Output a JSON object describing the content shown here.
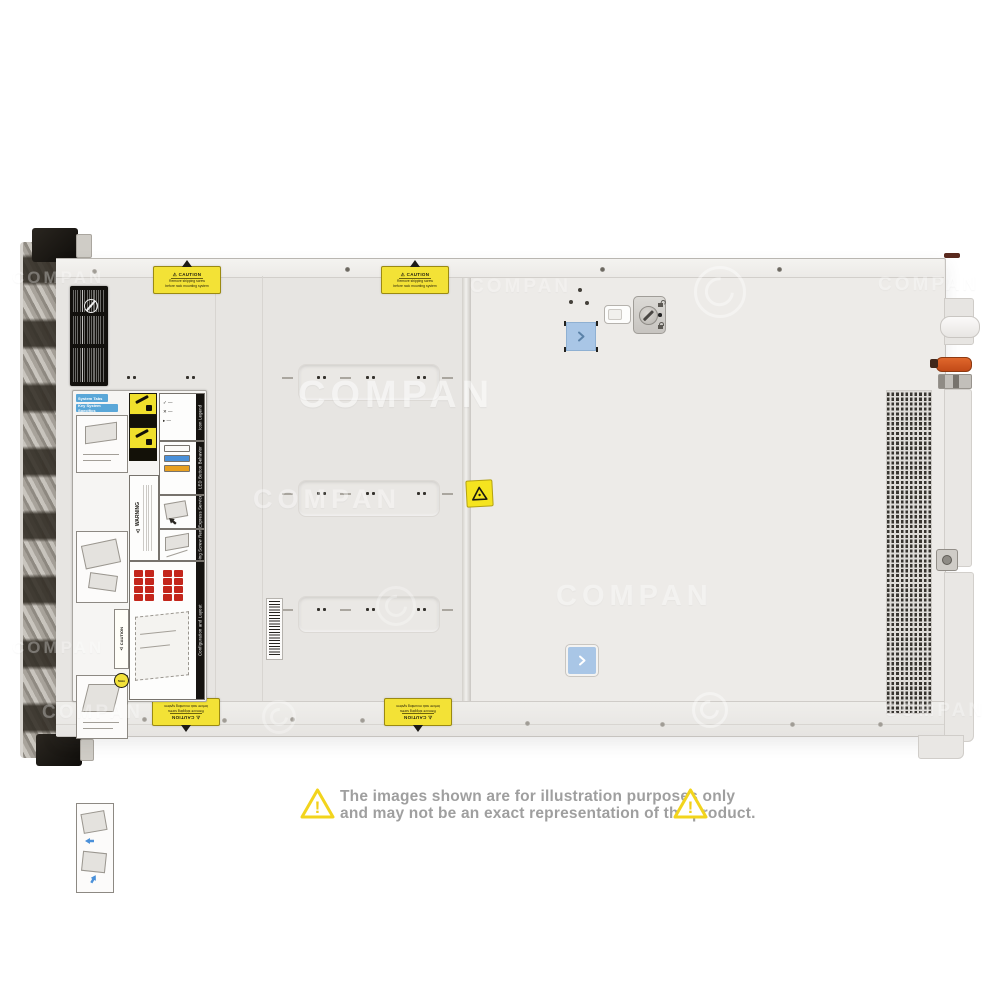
{
  "page": {
    "background": "#ffffff"
  },
  "watermark": {
    "text": "COMPAN"
  },
  "icons": {
    "warning": "⚠"
  },
  "disclaimer": {
    "line1": "The images shown are for illustration purposes only",
    "line2": "and may not be an exact representation of the product."
  },
  "server": {
    "caution_sticker": {
      "title": "CAUTION",
      "line1": "Remove shipping screw",
      "line2": "before rack mounting system"
    },
    "service_label": {
      "tab1": "System Tabs",
      "tab2": "Key System Specifics",
      "warning_heading": "WARNING",
      "caution_heading": "CAUTION",
      "timer": "5min",
      "sections": [
        {
          "title": "Icon Legend"
        },
        {
          "title": "LED Button Behavior"
        },
        {
          "title": "Rear Express Service Tag"
        },
        {
          "title": "Shipping Screw Removal"
        },
        {
          "title": "Configuration and Layout"
        }
      ]
    },
    "colors": {
      "caution_yellow": "#f2e13a",
      "button_blue": "#a9c6e6",
      "lever_orange": "#d4581f",
      "led_blue": "#4a90d9",
      "led_amber": "#e8a020",
      "drive_red": "#c3261b"
    }
  }
}
